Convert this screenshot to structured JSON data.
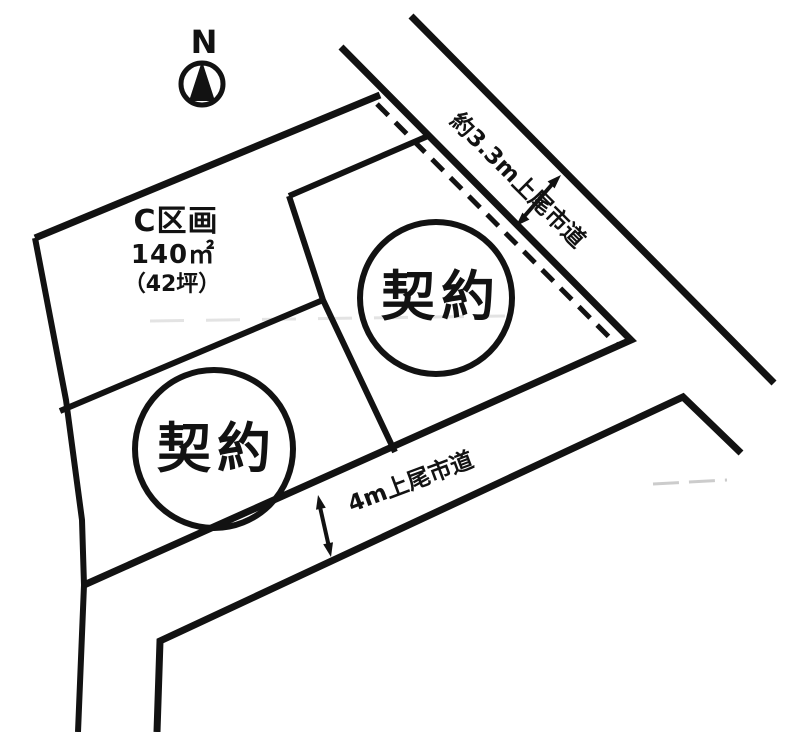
{
  "diagram": {
    "background": "#ffffff",
    "line_color": "#121212",
    "compass": {
      "label": "N"
    },
    "plot": {
      "name": "C区画",
      "area_m2": "140㎡",
      "area_tsubo": "（42坪）"
    },
    "contracts": [
      {
        "label": "契約"
      },
      {
        "label": "契約"
      }
    ],
    "roads": [
      {
        "label": "約3.3m上尾市道"
      },
      {
        "label": "4m上尾市道"
      }
    ]
  }
}
